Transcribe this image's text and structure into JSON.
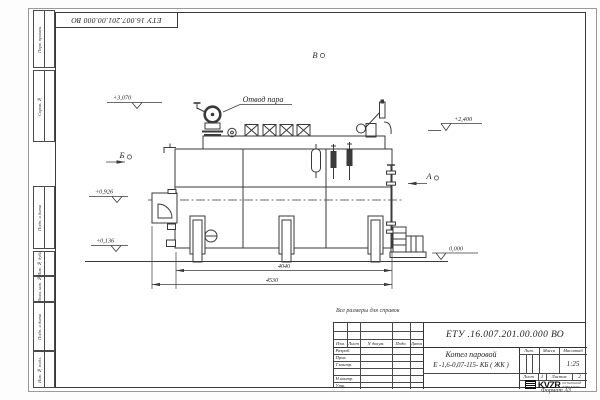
{
  "sheet": {
    "ink_color": "#3a3a3a",
    "stamp_number": "ЕТУ 16.007.201.00.000  ВО",
    "note": "Все размеры для справок",
    "format_label": "Формат  А3"
  },
  "frame": {
    "top_fields": [
      "Перв. примен.",
      "Справ. №"
    ],
    "bottom_fields": [
      "Подп. и дата",
      "Инв. № дубл.",
      "Взам. инв. №",
      "Подп. и дата",
      "Инв. № подл."
    ]
  },
  "drawing": {
    "steam_outlet_label": "Отвод пара",
    "view_a": "А",
    "view_b": "Б",
    "view_v": "В",
    "elev_top": "+3,070",
    "elev_right": "+2,400",
    "elev_mid": "+0,926",
    "elev_low": "+0,136",
    "elev_zero": "0,000",
    "dim_inner": "4040",
    "dim_outer": "4530"
  },
  "titleblock": {
    "doc_number": "ЕТУ .16.007.201.00.000  ВО",
    "product_name_line1": "Котел паровой",
    "product_name_line2": "Е -1,6-0,07-115- КБ ( ЖК )",
    "header_cols": [
      "Изм.",
      "Лист",
      "N докум.",
      "Подп.",
      "Дата"
    ],
    "sign_rows": [
      "Разраб.",
      "Пров.",
      "Т.контр.",
      "Н.контр.",
      "Утв."
    ],
    "lit_label": "Лит.",
    "mass_label": "Масса",
    "scale_label": "Масштаб",
    "scale_value": "1:25",
    "sheet_label": "Лист",
    "sheet_value": "1",
    "sheets_label": "Листов",
    "sheets_value": "2",
    "logo_text": "KVZR",
    "logo_sub_line1": "КОТЕЛЬНЫЙ",
    "logo_sub_line2": "ЗАВОД РЭП"
  }
}
